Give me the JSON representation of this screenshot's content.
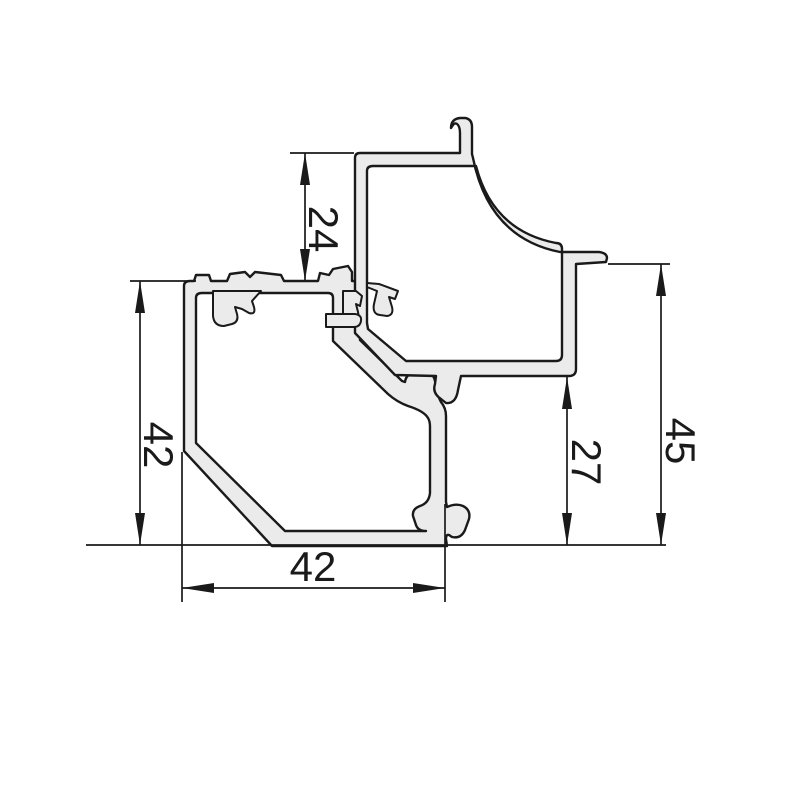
{
  "drawing": {
    "background_color": "#ffffff",
    "line_color": "#1a1a1a",
    "profile_fill_color": "#ebebeb",
    "dimensions": {
      "top_vertical_offset": "24",
      "left_profile_height": "42",
      "bottom_profile_width": "42",
      "right_step_height": "27",
      "right_total_height": "45"
    }
  }
}
